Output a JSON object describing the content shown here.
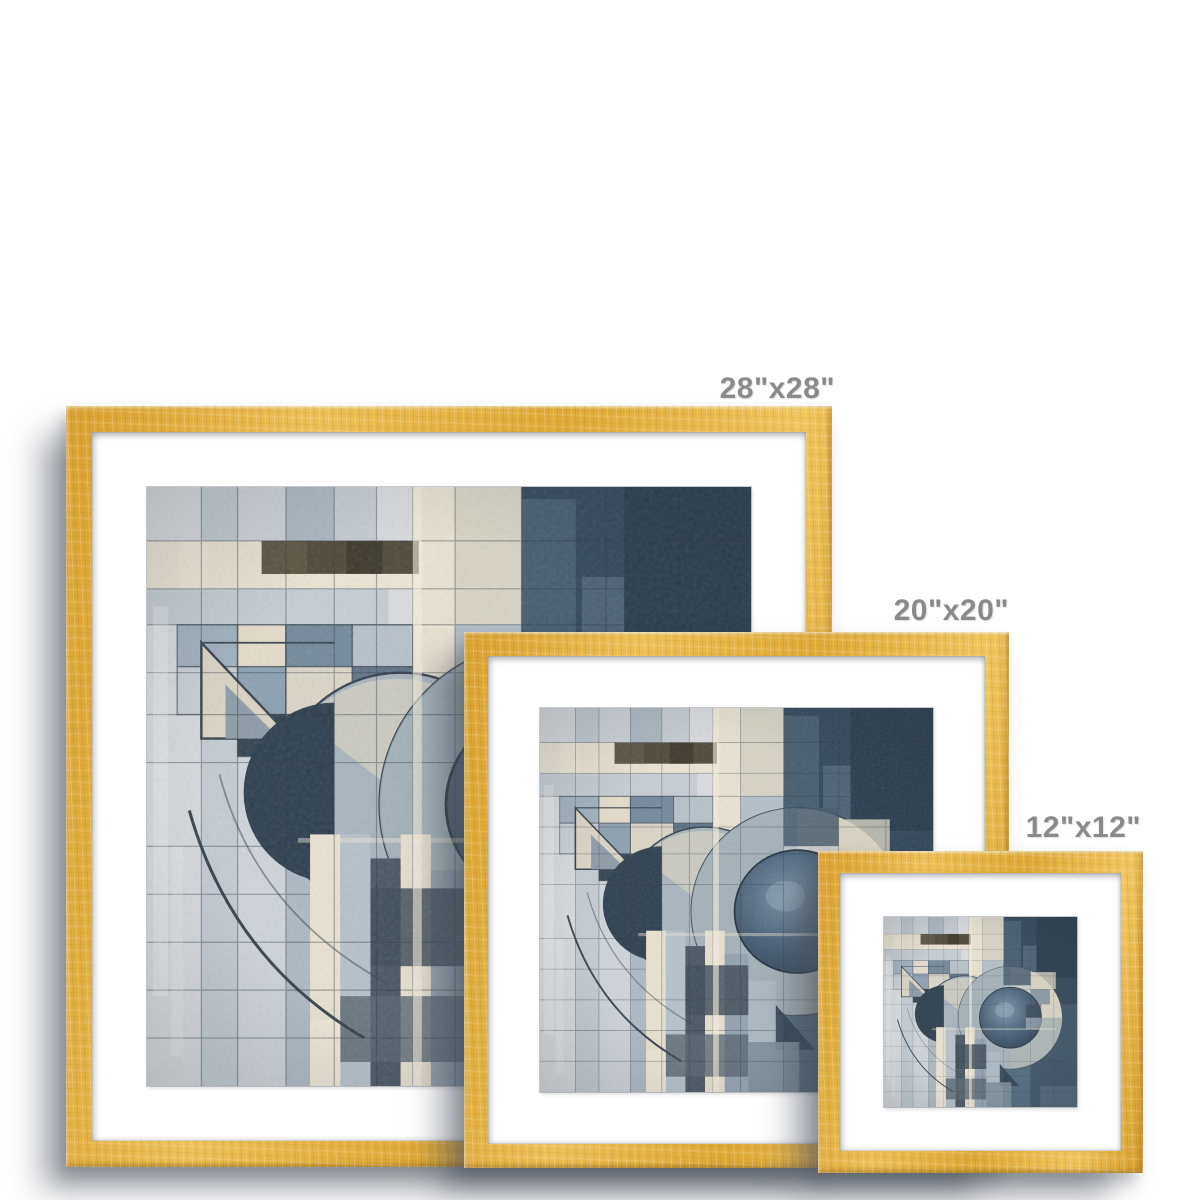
{
  "mockup": {
    "kind": "framed-print-size-comparison",
    "background": "#ffffff"
  },
  "frames": [
    {
      "name": "frame-28-inch",
      "label": "28\"x28\""
    },
    {
      "name": "frame-20-inch",
      "label": "20\"x20\""
    },
    {
      "name": "frame-12-inch",
      "label": "12\"x12\""
    }
  ],
  "colors": {
    "frame_wood": "#e2aa3b",
    "frame_wood_light": "#f0c45c",
    "frame_wood_dark": "#c8922b",
    "mat": "#ffffff",
    "label_text": "#8a8a8a",
    "drop_shadow": "rgba(72,78,90,0.5)",
    "artwork_palette": [
      "#cbd1d6",
      "#e9e2d2",
      "#52697d",
      "#32475a",
      "#2e3f4e",
      "#a9b4be",
      "#4f4939",
      "#d6d2c4"
    ]
  },
  "artwork": {
    "name": "abstract-geometric-print"
  }
}
